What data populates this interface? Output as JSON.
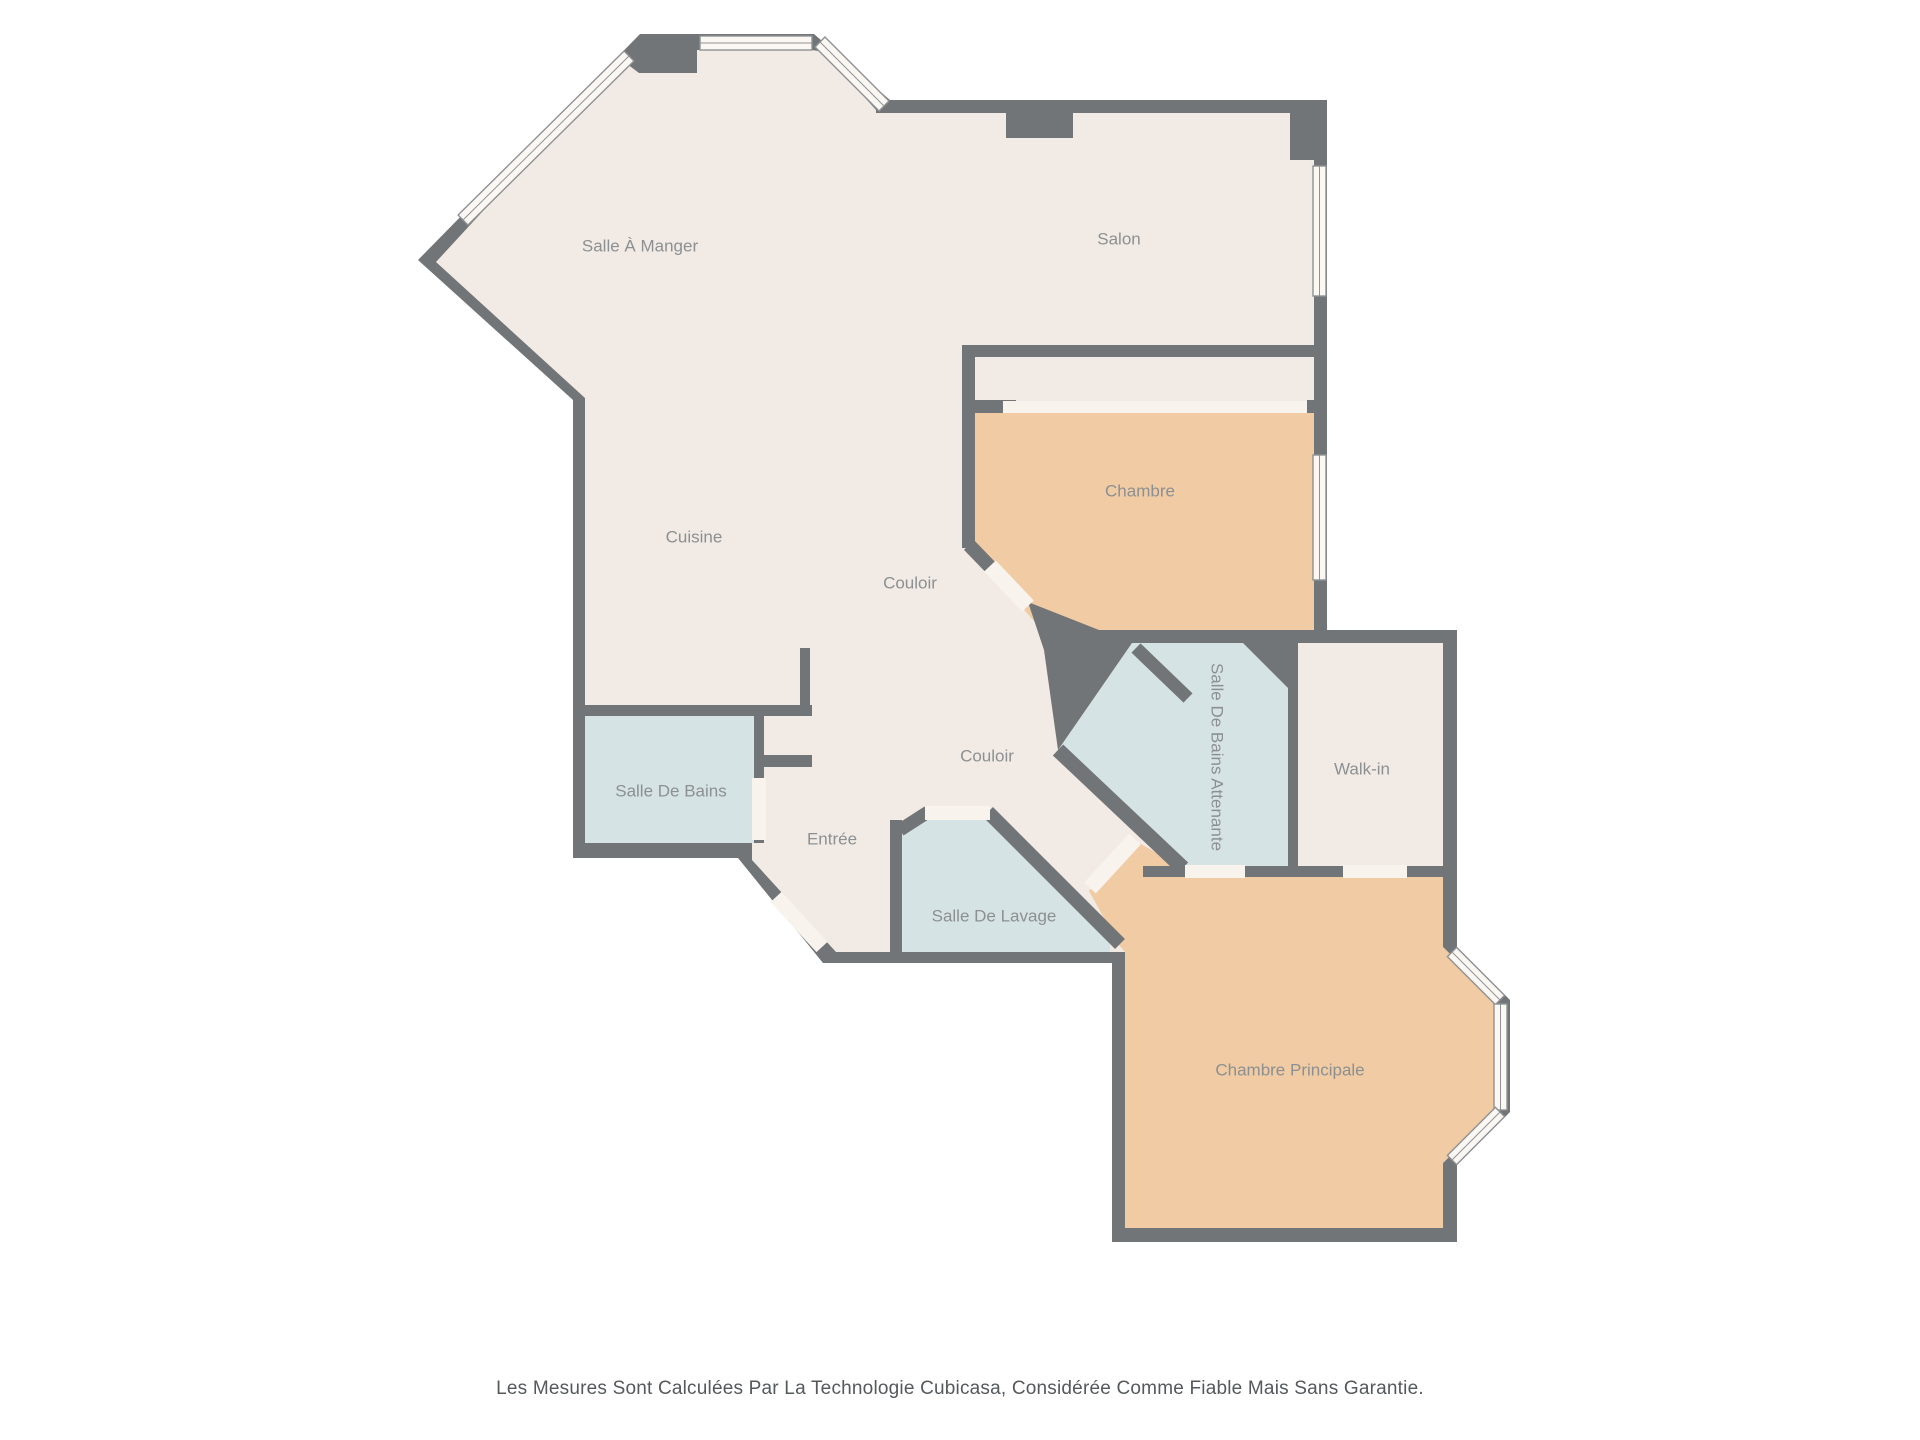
{
  "disclaimer": "Les Mesures Sont Calculées Par La Technologie Cubicasa, Considérée Comme Fiable Mais Sans Garantie.",
  "colors": {
    "wall": "#727577",
    "floor_cream": "#f2ebe5",
    "floor_peach": "#f0cba3",
    "floor_blue": "#d6e3e4",
    "window_fill": "#fbf8f4",
    "window_stroke": "#8f9294",
    "door_fill": "#f8f3ed",
    "label": "#8c9092"
  },
  "floorplan": {
    "silhouette": [
      [
        640,
        34
      ],
      [
        814,
        34
      ],
      [
        890,
        100
      ],
      [
        1327,
        100
      ],
      [
        1327,
        630
      ],
      [
        1457,
        630
      ],
      [
        1457,
        947
      ],
      [
        1510,
        1000
      ],
      [
        1510,
        1112
      ],
      [
        1457,
        1165
      ],
      [
        1457,
        1242
      ],
      [
        1112,
        1242
      ],
      [
        1112,
        963
      ],
      [
        823,
        963
      ],
      [
        738,
        858
      ],
      [
        573,
        858
      ],
      [
        573,
        400
      ],
      [
        418,
        260
      ]
    ],
    "interior": [
      [
        622,
        60
      ],
      [
        639,
        73
      ],
      [
        697,
        73
      ],
      [
        697,
        50
      ],
      [
        812,
        50
      ],
      [
        824,
        52
      ],
      [
        876,
        110
      ],
      [
        876,
        113
      ],
      [
        1006,
        113
      ],
      [
        1006,
        138
      ],
      [
        1073,
        138
      ],
      [
        1073,
        113
      ],
      [
        1314,
        113
      ],
      [
        1314,
        643
      ],
      [
        1443,
        643
      ],
      [
        1443,
        947
      ],
      [
        1452,
        956
      ],
      [
        1494,
        998
      ],
      [
        1494,
        1112
      ],
      [
        1452,
        1154
      ],
      [
        1443,
        1163
      ],
      [
        1443,
        1228
      ],
      [
        1125,
        1228
      ],
      [
        1125,
        952
      ],
      [
        836,
        952
      ],
      [
        752,
        860
      ],
      [
        752,
        843
      ],
      [
        585,
        843
      ],
      [
        585,
        398
      ],
      [
        436,
        262
      ]
    ],
    "rooms": [
      {
        "id": "chambre",
        "label": "Chambre",
        "color": "floor_peach",
        "points": [
          [
            975,
            413
          ],
          [
            1314,
            413
          ],
          [
            1314,
            630
          ],
          [
            1053,
            630
          ],
          [
            1040,
            628
          ],
          [
            981,
            560
          ],
          [
            975,
            553
          ]
        ],
        "label_x": 1140,
        "label_y": 492,
        "rot": 0
      },
      {
        "id": "chambre-principale",
        "label": "Chambre Principale",
        "color": "floor_peach",
        "points": [
          [
            1147,
            877
          ],
          [
            1443,
            877
          ],
          [
            1443,
            947
          ],
          [
            1452,
            956
          ],
          [
            1494,
            998
          ],
          [
            1494,
            1112
          ],
          [
            1452,
            1154
          ],
          [
            1443,
            1163
          ],
          [
            1443,
            1228
          ],
          [
            1125,
            1228
          ],
          [
            1125,
            952
          ],
          [
            1119,
            945
          ],
          [
            1089,
            891
          ],
          [
            1134,
            840
          ],
          [
            1183,
            868
          ],
          [
            1183,
            877
          ]
        ],
        "label_x": 1290,
        "label_y": 1071,
        "rot": 0
      },
      {
        "id": "salle-de-bains",
        "label": "Salle De Bains",
        "color": "floor_blue",
        "points": [
          [
            585,
            716
          ],
          [
            754,
            716
          ],
          [
            754,
            843
          ],
          [
            585,
            843
          ]
        ],
        "label_x": 671,
        "label_y": 792,
        "rot": 0
      },
      {
        "id": "salle-de-bains-attenante",
        "label": "Salle De Bains Attenante",
        "color": "floor_blue",
        "points": [
          [
            1132,
            643
          ],
          [
            1288,
            643
          ],
          [
            1288,
            867
          ],
          [
            1183,
            867
          ],
          [
            1058,
            750
          ]
        ],
        "label_x": 1216,
        "label_y": 757,
        "rot": 90
      },
      {
        "id": "salle-de-lavage",
        "label": "Salle De Lavage",
        "color": "floor_blue",
        "points": [
          [
            902,
            830
          ],
          [
            926,
            814
          ],
          [
            986,
            814
          ],
          [
            1110,
            938
          ],
          [
            1110,
            952
          ],
          [
            902,
            952
          ]
        ],
        "label_x": 994,
        "label_y": 917,
        "rot": 0
      },
      {
        "id": "salle-a-manger",
        "label": "Salle À Manger",
        "color": null,
        "points": null,
        "label_x": 640,
        "label_y": 247,
        "rot": 0
      },
      {
        "id": "salon",
        "label": "Salon",
        "color": null,
        "points": null,
        "label_x": 1119,
        "label_y": 240,
        "rot": 0
      },
      {
        "id": "cuisine",
        "label": "Cuisine",
        "color": null,
        "points": null,
        "label_x": 694,
        "label_y": 538,
        "rot": 0
      },
      {
        "id": "couloir-1",
        "label": "Couloir",
        "color": null,
        "points": null,
        "label_x": 910,
        "label_y": 584,
        "rot": 0
      },
      {
        "id": "couloir-2",
        "label": "Couloir",
        "color": null,
        "points": null,
        "label_x": 987,
        "label_y": 757,
        "rot": 0
      },
      {
        "id": "walk-in",
        "label": "Walk-in",
        "color": null,
        "points": null,
        "label_x": 1362,
        "label_y": 770,
        "rot": 0
      },
      {
        "id": "entree",
        "label": "Entrée",
        "color": null,
        "points": null,
        "label_x": 832,
        "label_y": 840,
        "rot": 0
      }
    ],
    "walls": [
      {
        "id": "salon-notch",
        "shape": "rect",
        "x": 1006,
        "y": 112,
        "w": 67,
        "h": 26
      },
      {
        "id": "salon-corner-column",
        "shape": "rect",
        "x": 1290,
        "y": 113,
        "w": 37,
        "h": 47
      },
      {
        "id": "salon-strip-wall",
        "shape": "rect",
        "x": 962,
        "y": 345,
        "w": 352,
        "h": 12
      },
      {
        "id": "strip-left-wall",
        "shape": "rect",
        "x": 962,
        "y": 345,
        "w": 13,
        "h": 203
      },
      {
        "id": "closet-stub-left",
        "shape": "rect",
        "x": 968,
        "y": 400,
        "w": 48,
        "h": 13
      },
      {
        "id": "closet-stub-right",
        "shape": "rect",
        "x": 1307,
        "y": 400,
        "w": 20,
        "h": 13
      },
      {
        "id": "chambre-diagonal-wall",
        "shape": "line",
        "x1": 969,
        "y1": 545,
        "x2": 1025,
        "y2": 603,
        "w": 14
      },
      {
        "id": "center-wall-chunk",
        "shape": "poly",
        "points": [
          [
            1028,
            602
          ],
          [
            1132,
            643
          ],
          [
            1058,
            750
          ],
          [
            1044,
            650
          ]
        ]
      },
      {
        "id": "chambre-bottom-wall",
        "shape": "rect",
        "x": 1053,
        "y": 630,
        "w": 261,
        "h": 13
      },
      {
        "id": "sdba-stub",
        "shape": "line",
        "x1": 1136,
        "y1": 648,
        "x2": 1188,
        "y2": 698,
        "w": 13
      },
      {
        "id": "sdba-corner-cut",
        "shape": "poly",
        "points": [
          [
            1243,
            643
          ],
          [
            1288,
            643
          ],
          [
            1288,
            688
          ]
        ]
      },
      {
        "id": "sdba-walkin-divider",
        "shape": "rect",
        "x": 1288,
        "y": 643,
        "w": 10,
        "h": 224
      },
      {
        "id": "sdba-walkin-bottom-wall",
        "shape": "rect",
        "x": 1143,
        "y": 866,
        "w": 300,
        "h": 11
      },
      {
        "id": "sdba-sw-wall",
        "shape": "line",
        "x1": 1058,
        "y1": 750,
        "x2": 1183,
        "y2": 868,
        "w": 15
      },
      {
        "id": "lavage-ne-wall",
        "shape": "line",
        "x1": 988,
        "y1": 812,
        "x2": 1120,
        "y2": 944,
        "w": 14
      },
      {
        "id": "lavage-left-wall",
        "shape": "rect",
        "x": 890,
        "y": 820,
        "w": 12,
        "h": 132
      },
      {
        "id": "lavage-corner-wall",
        "shape": "line",
        "x1": 900,
        "y1": 830,
        "x2": 928,
        "y2": 812,
        "w": 13
      },
      {
        "id": "cuisine-bottom-wall",
        "shape": "rect",
        "x": 573,
        "y": 705,
        "w": 239,
        "h": 11
      },
      {
        "id": "sdb-right-wall",
        "shape": "rect",
        "x": 754,
        "y": 716,
        "w": 10,
        "h": 127
      },
      {
        "id": "kitchen-stub-vertical",
        "shape": "rect",
        "x": 800,
        "y": 648,
        "w": 10,
        "h": 58
      },
      {
        "id": "kitchen-stub-horizontal",
        "shape": "rect",
        "x": 764,
        "y": 755,
        "w": 48,
        "h": 12
      }
    ],
    "windows": [
      {
        "id": "window-dining-top",
        "shape": "rect",
        "x": 700,
        "y": 36,
        "w": 112,
        "h": 14
      },
      {
        "id": "window-dining-diag-right",
        "shape": "line",
        "x1": 820,
        "y1": 42,
        "x2": 884,
        "y2": 106,
        "w": 14
      },
      {
        "id": "window-dining-diag-left",
        "shape": "line",
        "x1": 463,
        "y1": 220,
        "x2": 629,
        "y2": 56,
        "w": 14
      },
      {
        "id": "window-salon-right",
        "shape": "rect",
        "x": 1313,
        "y": 166,
        "w": 13,
        "h": 130
      },
      {
        "id": "window-chambre-right",
        "shape": "rect",
        "x": 1313,
        "y": 455,
        "w": 13,
        "h": 125
      },
      {
        "id": "window-bay-top",
        "shape": "line",
        "x1": 1452,
        "y1": 952,
        "x2": 1500,
        "y2": 1000,
        "w": 13
      },
      {
        "id": "window-bay-middle",
        "shape": "rect",
        "x": 1494,
        "y": 1004,
        "w": 13,
        "h": 106
      },
      {
        "id": "window-bay-bottom",
        "shape": "line",
        "x1": 1500,
        "y1": 1112,
        "x2": 1452,
        "y2": 1160,
        "w": 13
      }
    ],
    "doors": [
      {
        "id": "door-chambre-closet",
        "shape": "rect",
        "x": 1003,
        "y": 401,
        "w": 304,
        "h": 12
      },
      {
        "id": "door-chambre",
        "shape": "line",
        "x1": 990,
        "y1": 566,
        "x2": 1028,
        "y2": 606,
        "w": 16
      },
      {
        "id": "door-chambre-principale",
        "shape": "line",
        "x1": 1090,
        "y1": 888,
        "x2": 1135,
        "y2": 839,
        "w": 16
      },
      {
        "id": "door-sdba",
        "shape": "rect",
        "x": 1185,
        "y": 865,
        "w": 60,
        "h": 13
      },
      {
        "id": "door-walkin",
        "shape": "rect",
        "x": 1343,
        "y": 865,
        "w": 64,
        "h": 13
      },
      {
        "id": "door-lavage",
        "shape": "rect",
        "x": 925,
        "y": 806,
        "w": 65,
        "h": 14
      },
      {
        "id": "door-sdb",
        "shape": "rect",
        "x": 752,
        "y": 778,
        "w": 14,
        "h": 62
      },
      {
        "id": "door-entry",
        "shape": "line",
        "x1": 776,
        "y1": 897,
        "x2": 822,
        "y2": 947,
        "w": 15
      }
    ],
    "label_font_size": 17
  }
}
